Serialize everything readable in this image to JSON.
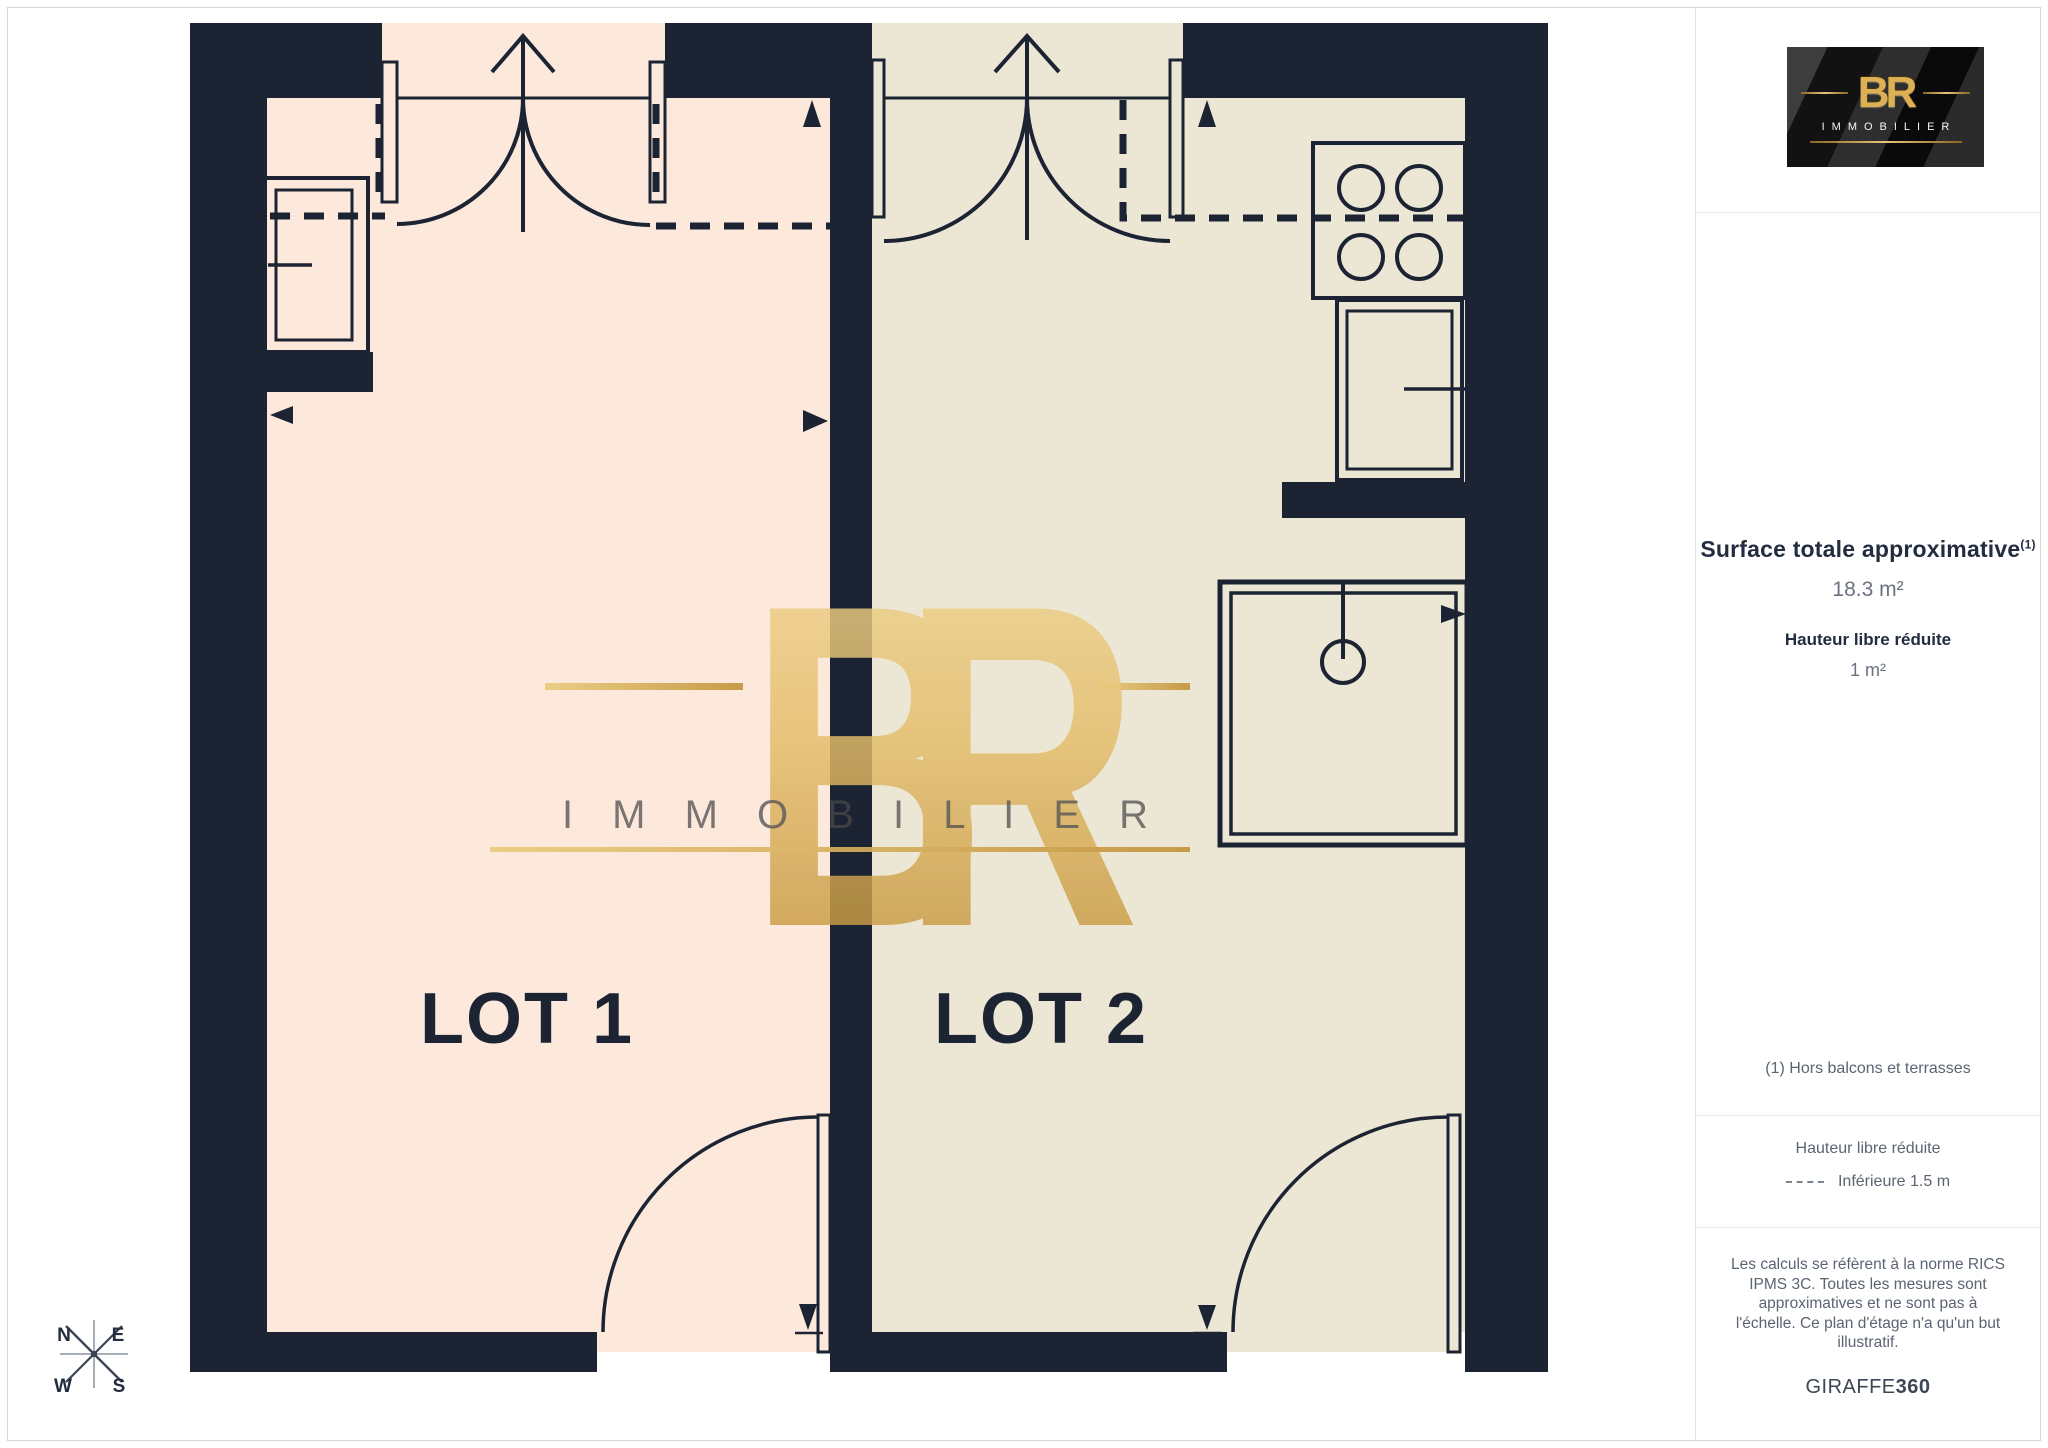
{
  "colors": {
    "wall": "#1C2433",
    "lot1_fill": "#FCE9DB",
    "lot2_fill": "#ECE7D5",
    "gold": "#D9AE5F",
    "title_text": "#232D3F",
    "muted_text": "#5B6472"
  },
  "logo": {
    "monogram": "BR",
    "name": "IMMOBILIER"
  },
  "watermark": {
    "monogram": "BR",
    "name": "I M M O B I L I E R"
  },
  "floorplan": {
    "lots": [
      {
        "label": "LOT 1"
      },
      {
        "label": "LOT 2"
      }
    ]
  },
  "compass": {
    "n": "N",
    "e": "E",
    "w": "W",
    "s": "S"
  },
  "sidebar": {
    "surface_title": "Surface totale approximative",
    "surface_sup": "(1)",
    "surface_value": "18.3 m²",
    "height_title": "Hauteur libre réduite",
    "height_value": "1 m²",
    "note": "(1) Hors balcons et terrasses",
    "legend_title": "Hauteur libre réduite",
    "legend_value": "Inférieure 1.5 m",
    "disclaimer": "Les calculs se réfèrent à la norme RICS IPMS 3C. Toutes les mesures sont approximatives et ne sont pas à l'échelle. Ce plan d'étage n'a qu'un but illustratif.",
    "brand": "GIRAFFE",
    "brand_bold": "360"
  }
}
